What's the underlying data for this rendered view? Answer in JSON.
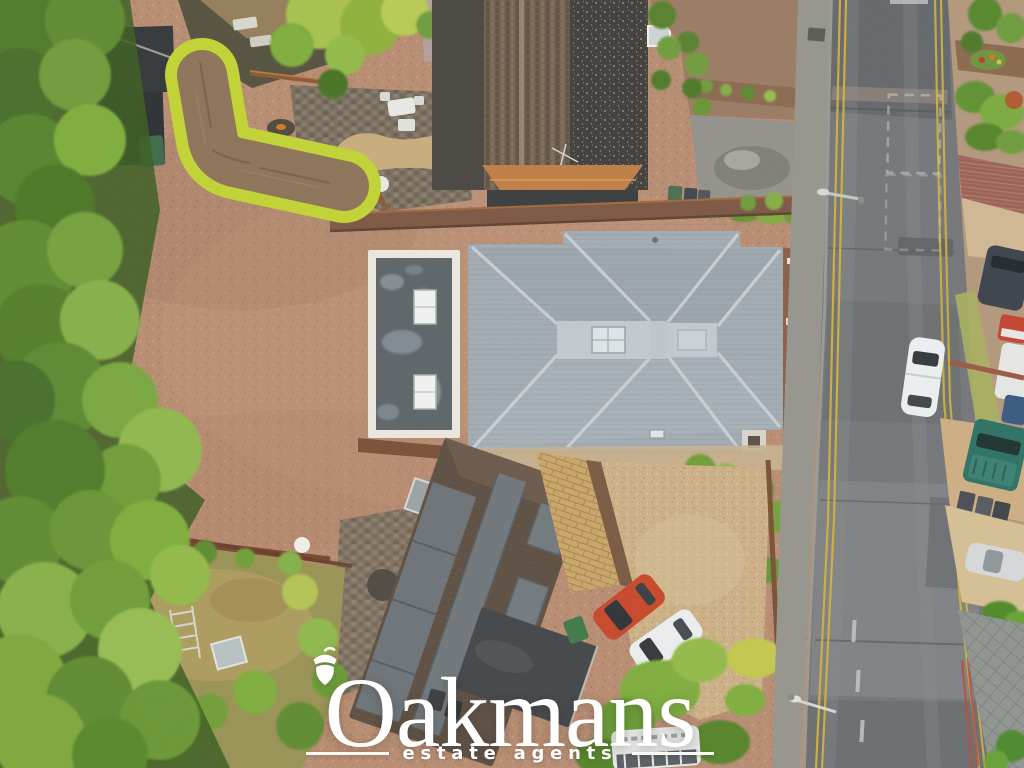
{
  "watermark": {
    "brand": "Oakmans",
    "tagline": "estate agents",
    "color": "#ffffff"
  },
  "scene": {
    "type": "aerial-drone-photo-of-property",
    "objects": [
      "grey-hipped-roof-bungalow",
      "flat-roof-annex",
      "gravel-driveway",
      "l-shaped-boundary-hedge",
      "north-neighbour-house",
      "patio-garden",
      "south-neighbour-house",
      "block-paved-path",
      "residential-road",
      "footpath",
      "double-yellow-lines",
      "parked-white-car",
      "orange-car",
      "white-car",
      "teal-pickup",
      "silver-car",
      "caravan",
      "conifer-tree-line",
      "rear-garden-lawn"
    ],
    "palette": {
      "gravel": "#b88d72",
      "main_roof": "#a3acb4",
      "roof_flat_top": "#c3cad0",
      "flat_roof": "#5d6569",
      "road": "#74777a",
      "footpath": "#96968e",
      "yellow_line": "#d2b13c",
      "hedge_border": "#c2d434",
      "hedge_core": "#8d7459",
      "tree_green": "#5c8a30",
      "lawn": "#ad9c5e",
      "block_paving": "#c9a66a",
      "old_roof": "#6f6050",
      "slate_roof": "#413f3b",
      "south_roof": "#5f5044",
      "porch": "#bf7f45",
      "brick_verge": "#9a6156",
      "car_orange": "#c8482a",
      "car_teal": "#2d7265",
      "car_white": "#eceff0",
      "sand_drive": "#d6c096"
    }
  }
}
